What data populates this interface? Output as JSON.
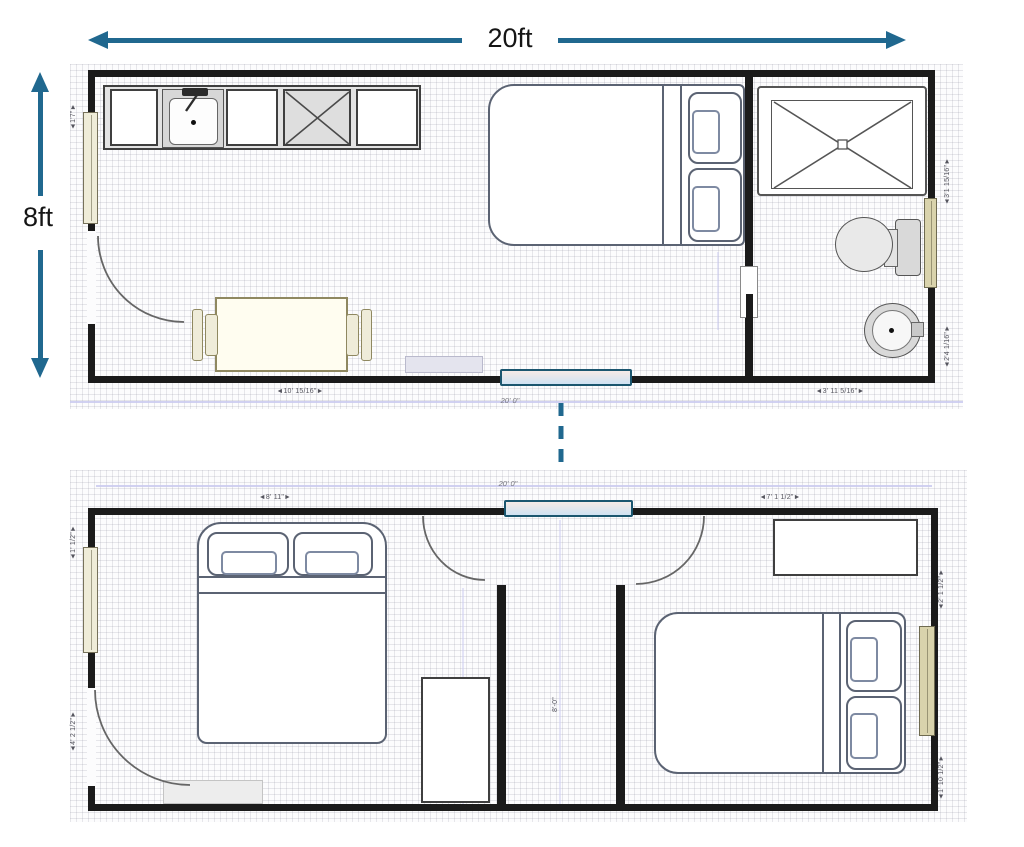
{
  "dimensions": {
    "width_label": "20ft",
    "height_label": "8ft"
  },
  "colors": {
    "arrow_teal": "#20688f",
    "wall_black": "#1b1b1b",
    "window_blue": "#cfe2f2",
    "window_tan": "#d9d3ac",
    "furniture_gray": "#5b6373"
  },
  "upper_plan": {
    "dims": {
      "left_top": "◄1'7\"►",
      "right_top": "◄3'1 15/16\"►",
      "right_bottom": "◄2'4 1/16\"►",
      "bottom_left": "◄10' 15/16\"►",
      "bottom_center": "20' 0\"",
      "bottom_right": "◄3' 11 5/16\"►"
    },
    "furniture": [
      "kitchen counter",
      "sink",
      "cooktop",
      "queen bed",
      "dining table",
      "two chairs",
      "shower",
      "toilet",
      "round basin",
      "entry door",
      "pocket door",
      "windows"
    ]
  },
  "lower_plan": {
    "dims": {
      "top_left": "◄8' 11\"►",
      "top_center": "20' 0\"",
      "top_right": "◄7' 1 1/2\"►",
      "left_top": "◄1' 1/2\"►",
      "left_bottom": "◄4' 2 1/2\"►",
      "center": "8'-0\"",
      "right_top": "◄2' 1 1/2\"►",
      "right_bottom": "◄1' 10 1/2\"►"
    },
    "furniture": [
      "double bed",
      "wardrobe",
      "dresser",
      "double bed with pillows",
      "entry door",
      "interior doors",
      "windows"
    ]
  }
}
